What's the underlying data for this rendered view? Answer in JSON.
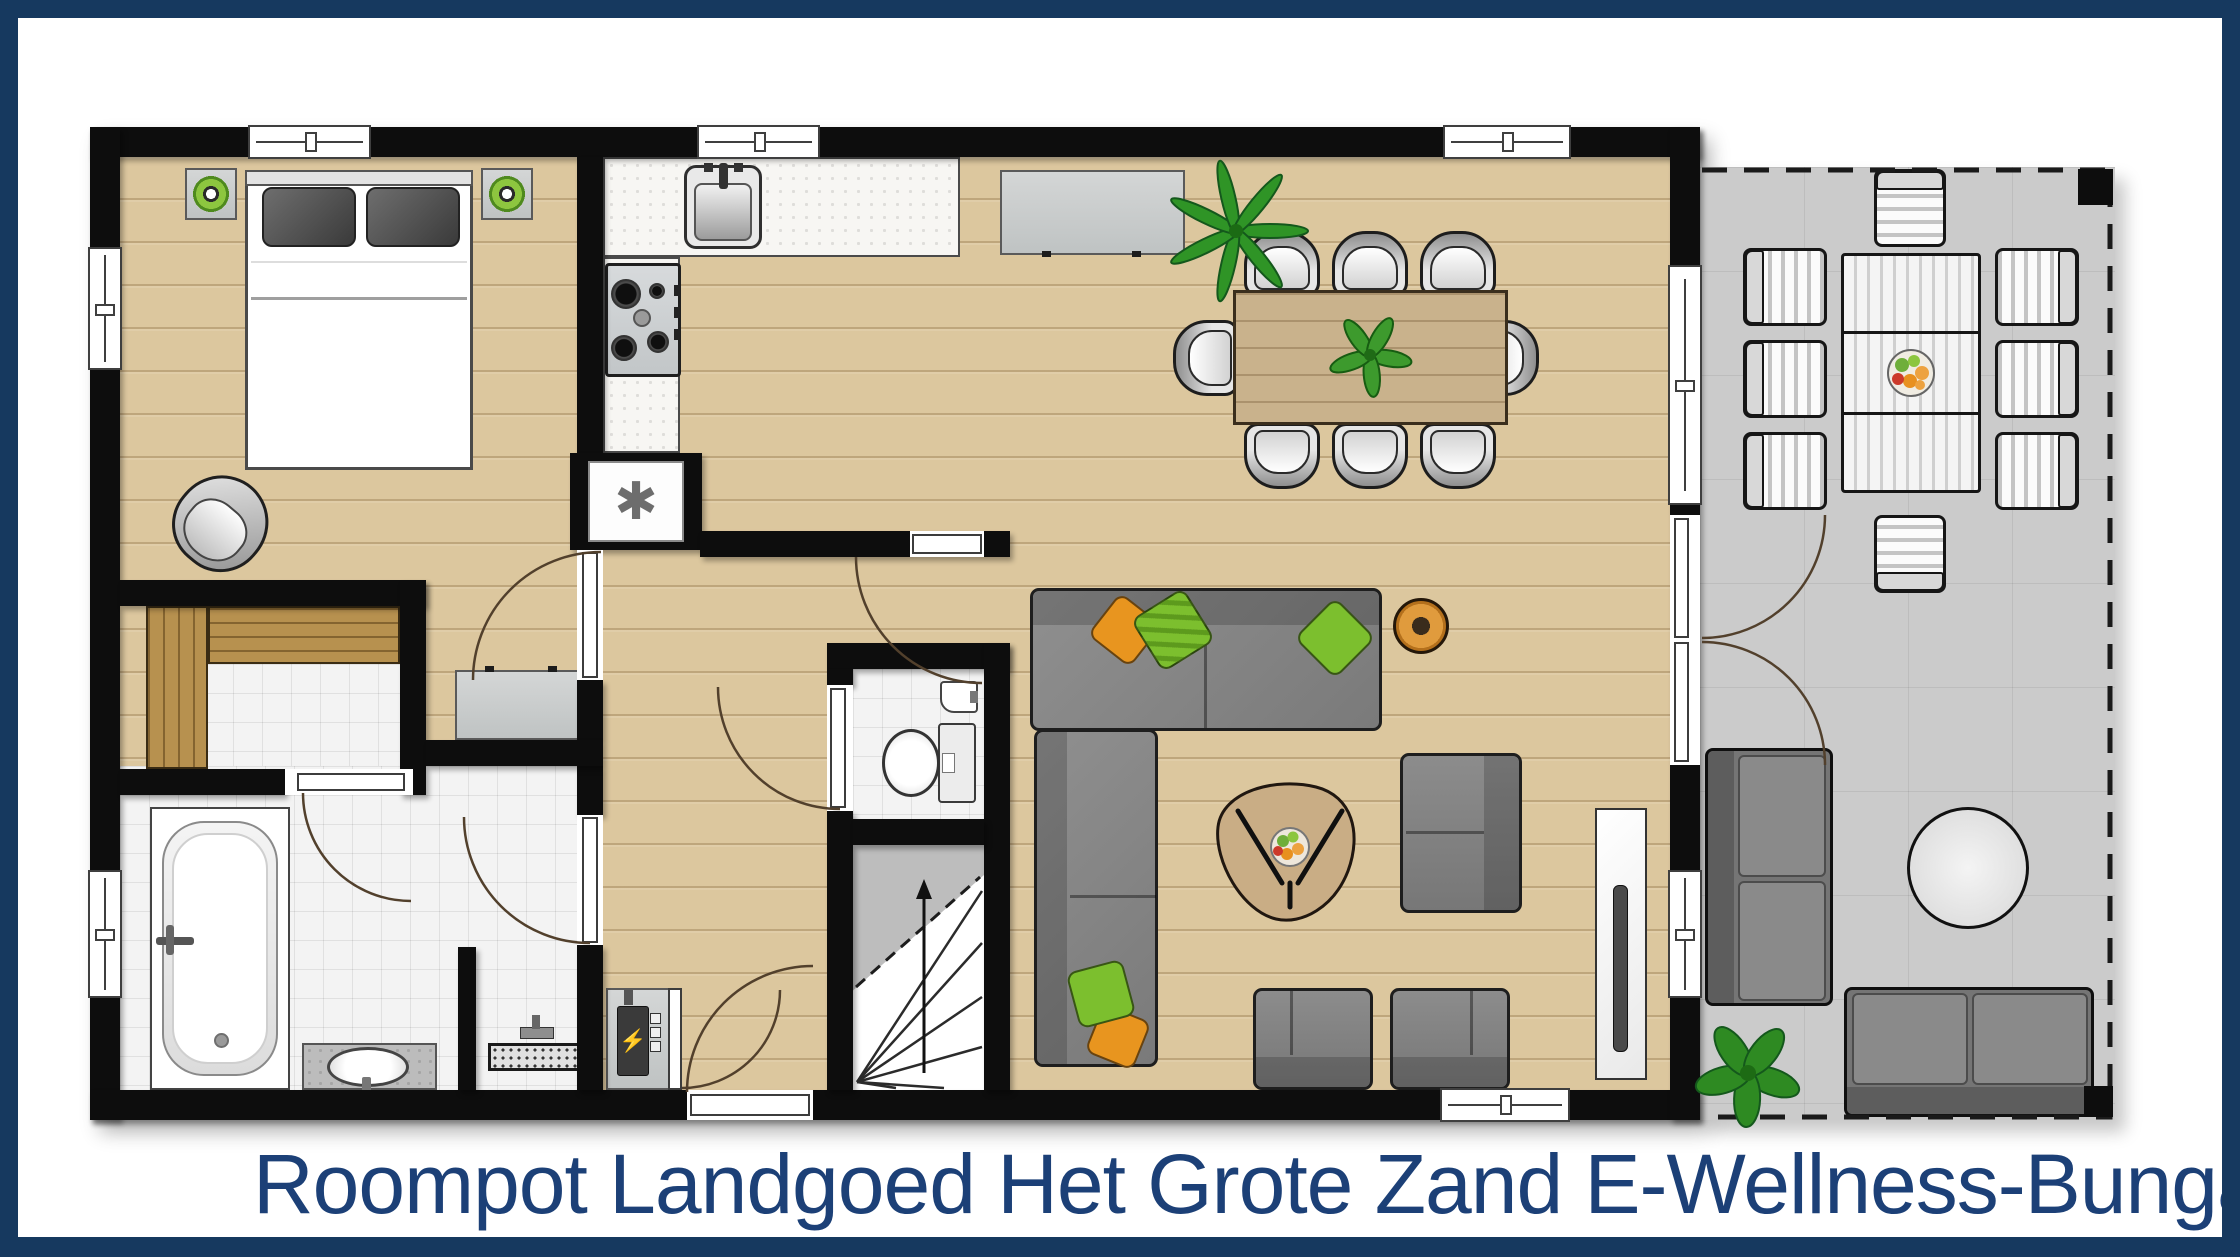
{
  "title": {
    "text": "Roompot Landgoed Het Grote Zand E-Wellness-Bungal"
  },
  "theme": {
    "frame_color": "#16395f",
    "title_color": "#1c4077",
    "wall_color": "#0d0d0d",
    "wood_floor_color": "#dcc79e",
    "terrace_floor_color": "#cbcbcb",
    "tile_floor_color": "#f3f3f3",
    "sauna_wood_color": "#b7914f",
    "sofa_gray": "#808080",
    "pillow_green": "#7cbf2e",
    "pillow_orange": "#e8951f",
    "plant_green": "#2f9426"
  },
  "symbols": {
    "freezer": "✱",
    "electric": "⚡"
  }
}
